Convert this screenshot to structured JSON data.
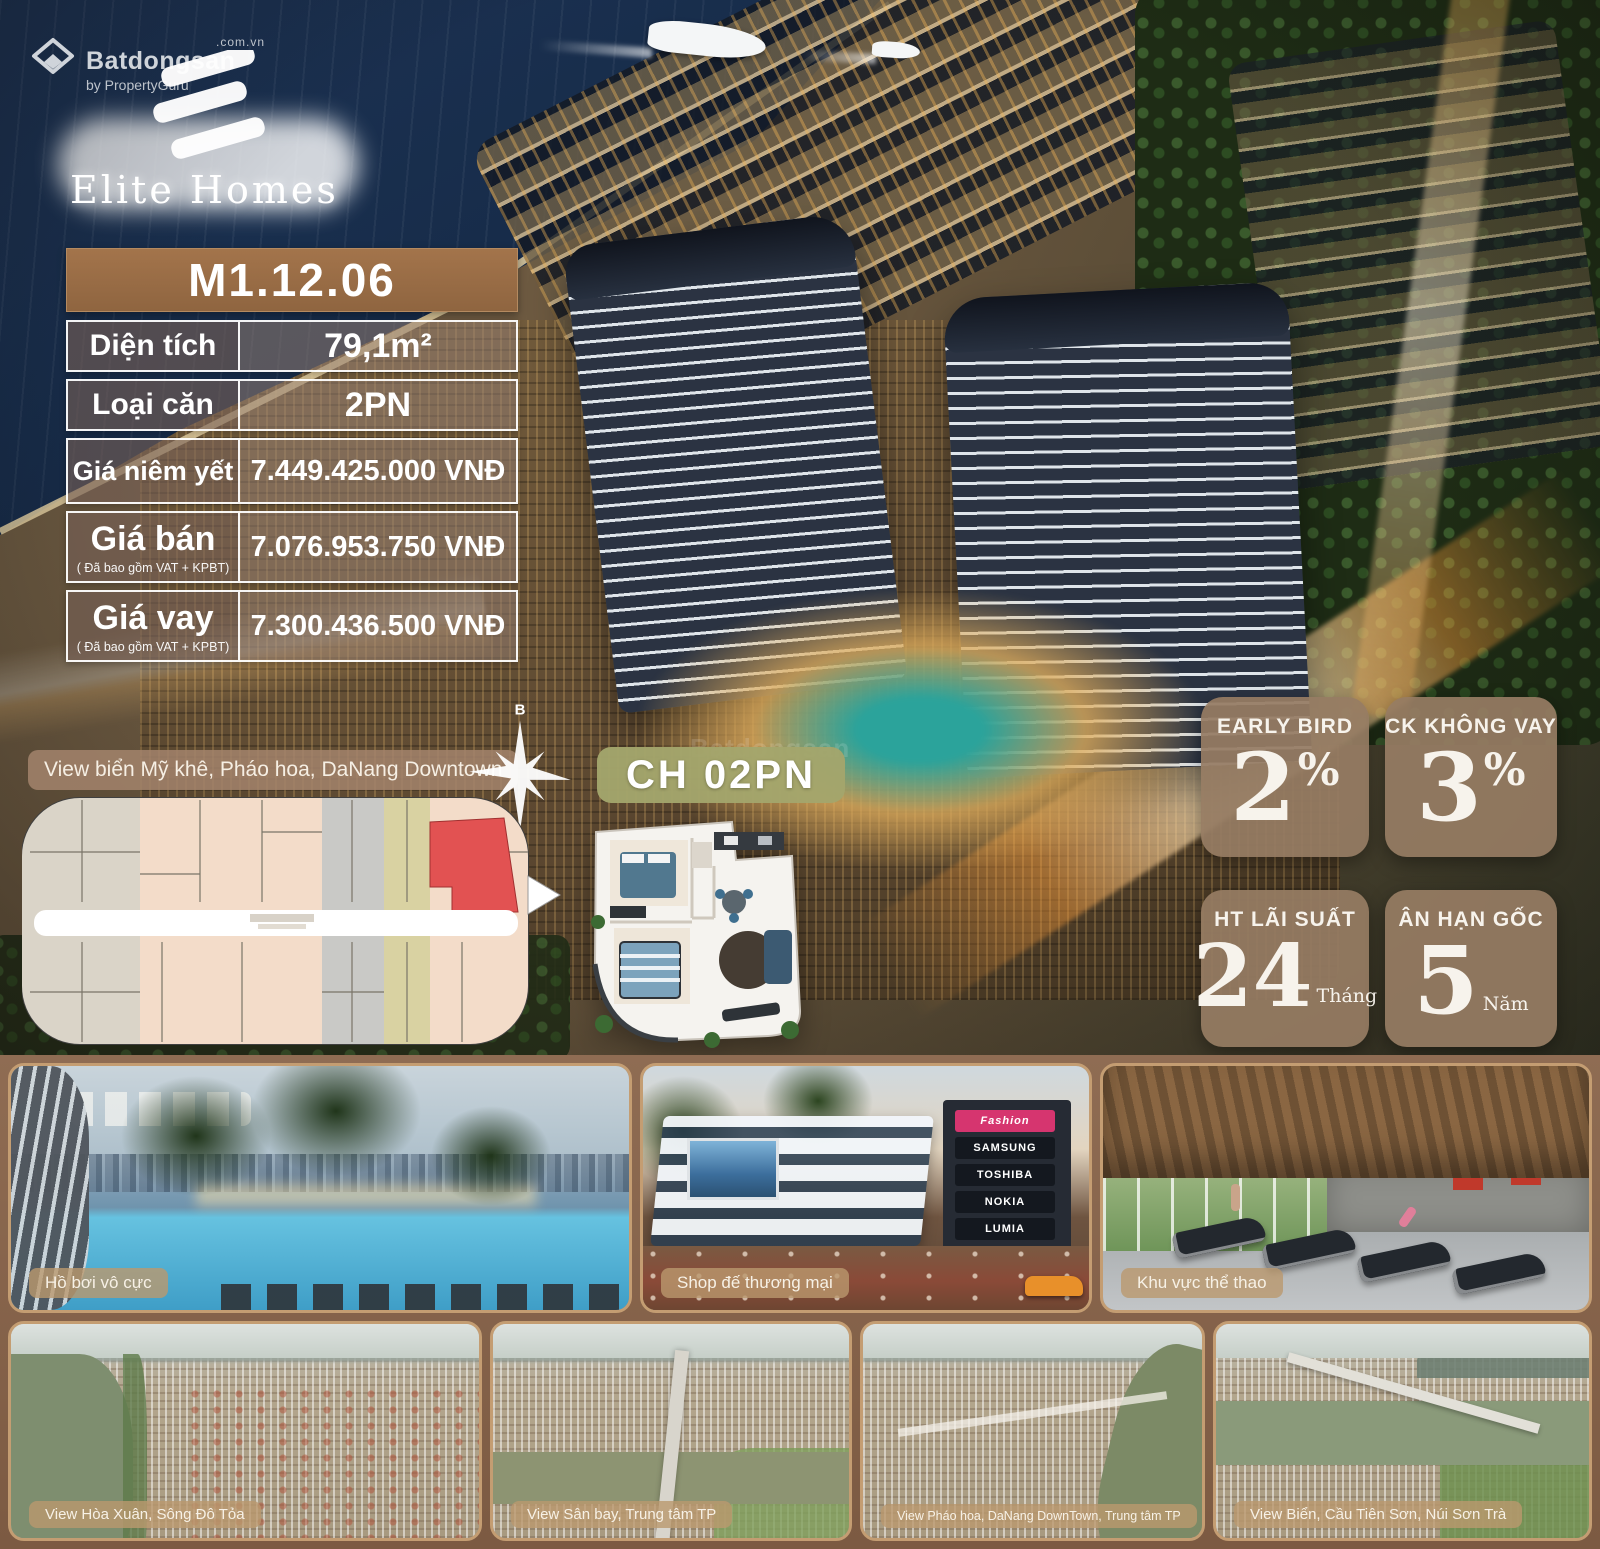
{
  "watermark": {
    "brand": "Batdongsan",
    "domain": ".com.vn",
    "byline": "by PropertyGuru"
  },
  "brand": {
    "name": "Elite Homes"
  },
  "unit_table": {
    "code": "M1.12.06",
    "rows": [
      {
        "label": "Diện tích",
        "sub": "",
        "value": "79,1m²"
      },
      {
        "label": "Loại căn",
        "sub": "",
        "value": "2PN"
      },
      {
        "label": "Giá niêm yết",
        "sub": "",
        "value": "7.449.425.000 VNĐ"
      },
      {
        "label": "Giá bán",
        "sub": "( Đã bao gồm VAT + KPBT)",
        "value": "7.076.953.750 VNĐ"
      },
      {
        "label": "Giá vay",
        "sub": "( Đã bao gồm VAT + KPBT)",
        "value": "7.300.436.500 VNĐ"
      }
    ]
  },
  "view_note": "View biển Mỹ khê, Pháo hoa, DaNang Downtown",
  "unit_tag": "CH 02PN",
  "compass": {
    "top": "B",
    "bottom": "N"
  },
  "promos": [
    {
      "title": "EARLY BIRD",
      "value": "2",
      "unit": "%"
    },
    {
      "title": "CK KHÔNG VAY",
      "value": "3",
      "unit": "%"
    },
    {
      "title": "HT LÃI SUẤT",
      "value": "24",
      "unit": "Tháng"
    },
    {
      "title": "ÂN HẠN GỐC",
      "value": "5",
      "unit": "Năm"
    }
  ],
  "gallery": {
    "row1": [
      {
        "caption": "Hồ bơi vô cực"
      },
      {
        "caption": "Shop đế thương mại",
        "signs": [
          "Fashion",
          "SAMSUNG",
          "TOSHIBA",
          "NOKIA",
          "LUMIA"
        ]
      },
      {
        "caption": "Khu vực thể thao"
      }
    ],
    "row2": [
      {
        "caption": "View Hòa Xuân, Sông Đô Tỏa"
      },
      {
        "caption": "View Sân bay, Trung tâm TP"
      },
      {
        "caption": "View Pháo hoa, DaNang DownTown, Trung tâm TP"
      },
      {
        "caption": "View Biển, Cầu Tiên Sơn, Núi Sơn Trà"
      }
    ]
  },
  "colors": {
    "table_header": "#9b6f47",
    "promo_box": "#967c63",
    "unit_tag_bg": "#a3a56c",
    "gallery_bg": "#8a6750",
    "highlight_unit_red": "#e25252",
    "sea_navy": "#152a47"
  }
}
